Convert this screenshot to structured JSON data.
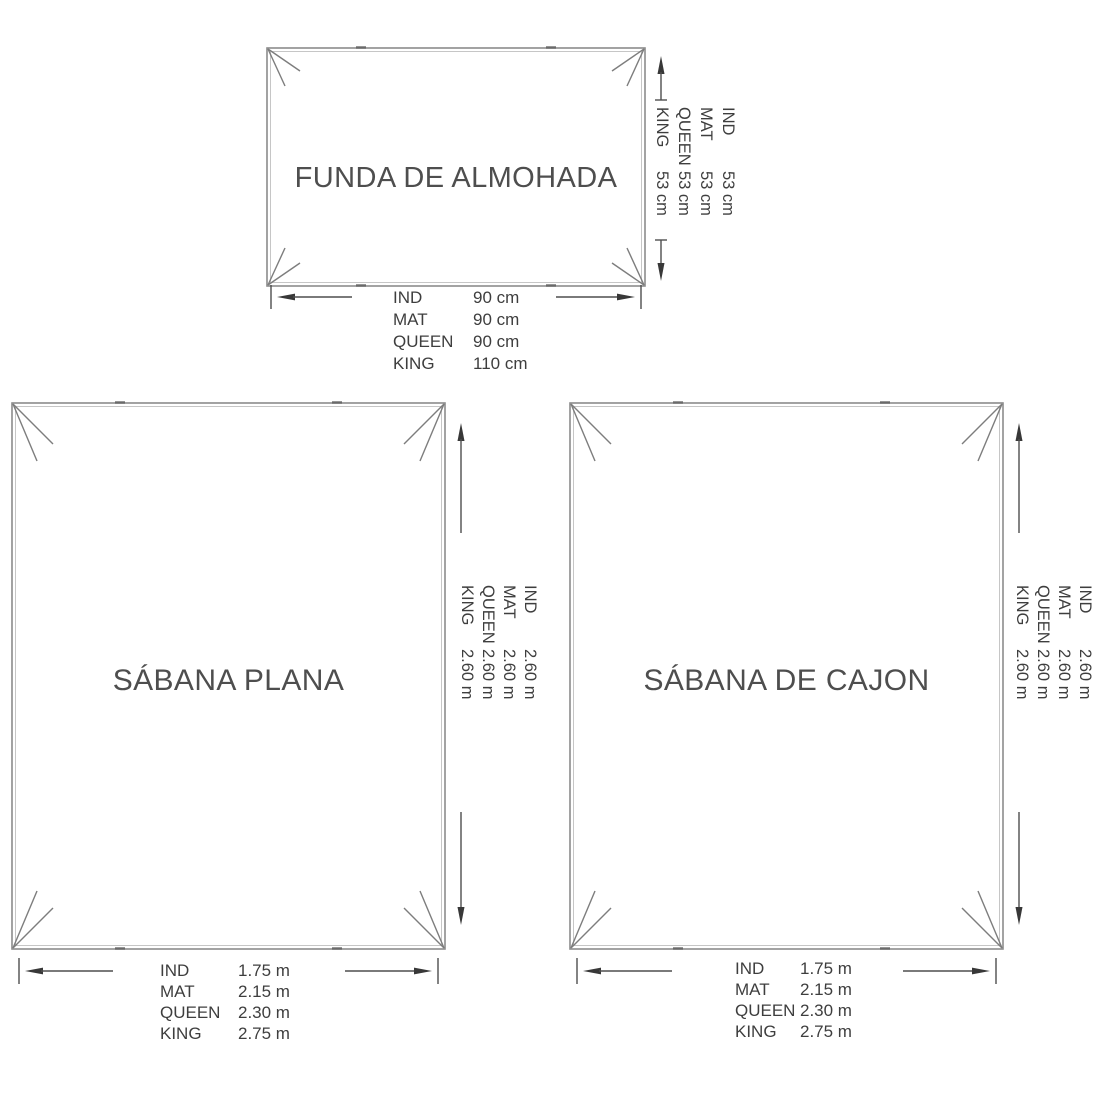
{
  "colors": {
    "background": "#ffffff",
    "outline_gray": "#8c8c8c",
    "inner_outline_gray": "#c2c2c2",
    "dimension_line": "#4e4e4e",
    "text_gray": "#3e3e3e"
  },
  "panels": {
    "pillowcase": {
      "title": "FUNDA DE ALMOHADA",
      "side": {
        "rows": [
          {
            "label": "IND",
            "value": "53 cm"
          },
          {
            "label": "MAT",
            "value": "53 cm"
          },
          {
            "label": "QUEEN",
            "value": "53 cm"
          },
          {
            "label": "KING",
            "value": "53 cm"
          }
        ]
      },
      "bottom": {
        "rows": [
          {
            "label": "IND",
            "value": "90 cm"
          },
          {
            "label": "MAT",
            "value": "90 cm"
          },
          {
            "label": "QUEEN",
            "value": "90 cm"
          },
          {
            "label": "KING",
            "value": "110 cm"
          }
        ]
      }
    },
    "flat_sheet": {
      "title": "SÁBANA PLANA",
      "side": {
        "rows": [
          {
            "label": "IND",
            "value": "2.60 m"
          },
          {
            "label": "MAT",
            "value": "2.60 m"
          },
          {
            "label": "QUEEN",
            "value": "2.60 m"
          },
          {
            "label": "KING",
            "value": "2.60 m"
          }
        ]
      },
      "bottom": {
        "rows": [
          {
            "label": "IND",
            "value": "1.75 m"
          },
          {
            "label": "MAT",
            "value": "2.15 m"
          },
          {
            "label": "QUEEN",
            "value": "2.30 m"
          },
          {
            "label": "KING",
            "value": "2.75 m"
          }
        ]
      }
    },
    "fitted_sheet": {
      "title": "SÁBANA DE CAJON",
      "side": {
        "rows": [
          {
            "label": "IND",
            "value": "2.60 m"
          },
          {
            "label": "MAT",
            "value": "2.60 m"
          },
          {
            "label": "QUEEN",
            "value": "2.60 m"
          },
          {
            "label": "KING",
            "value": "2.60 m"
          }
        ]
      },
      "bottom": {
        "rows": [
          {
            "label": "IND",
            "value": "1.75 m"
          },
          {
            "label": "MAT",
            "value": "2.15 m"
          },
          {
            "label": "QUEEN",
            "value": "2.30 m"
          },
          {
            "label": "KING",
            "value": "2.75 m"
          }
        ]
      }
    }
  }
}
